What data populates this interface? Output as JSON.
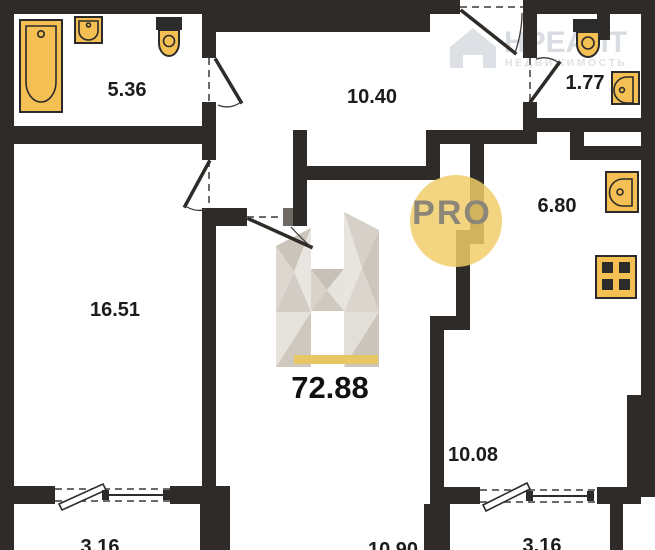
{
  "areas": {
    "bathroom": "5.36",
    "hallway": "10.40",
    "wc": "1.77",
    "kitchen": "6.80",
    "room_left": "16.51",
    "room_middle": "10.90",
    "room_right": "10.08",
    "balcony_left": "3.16",
    "balcony_right": "3.16"
  },
  "total_area": "72.88",
  "badge": {
    "label": "PRO"
  },
  "watermark": {
    "brand": "НРЕАЛТ",
    "subtitle": "НЕДВИЖИМОСТЬ"
  },
  "colors": {
    "wall": "#2e2b28",
    "fixture_fill": "#f4bf53",
    "fixture_outline": "#2b2b2b",
    "badge_fill": "#f1cd69",
    "badge_text": "#8c8678",
    "logo_accent": "#e7c666",
    "label_text": "#1c1c1c"
  }
}
